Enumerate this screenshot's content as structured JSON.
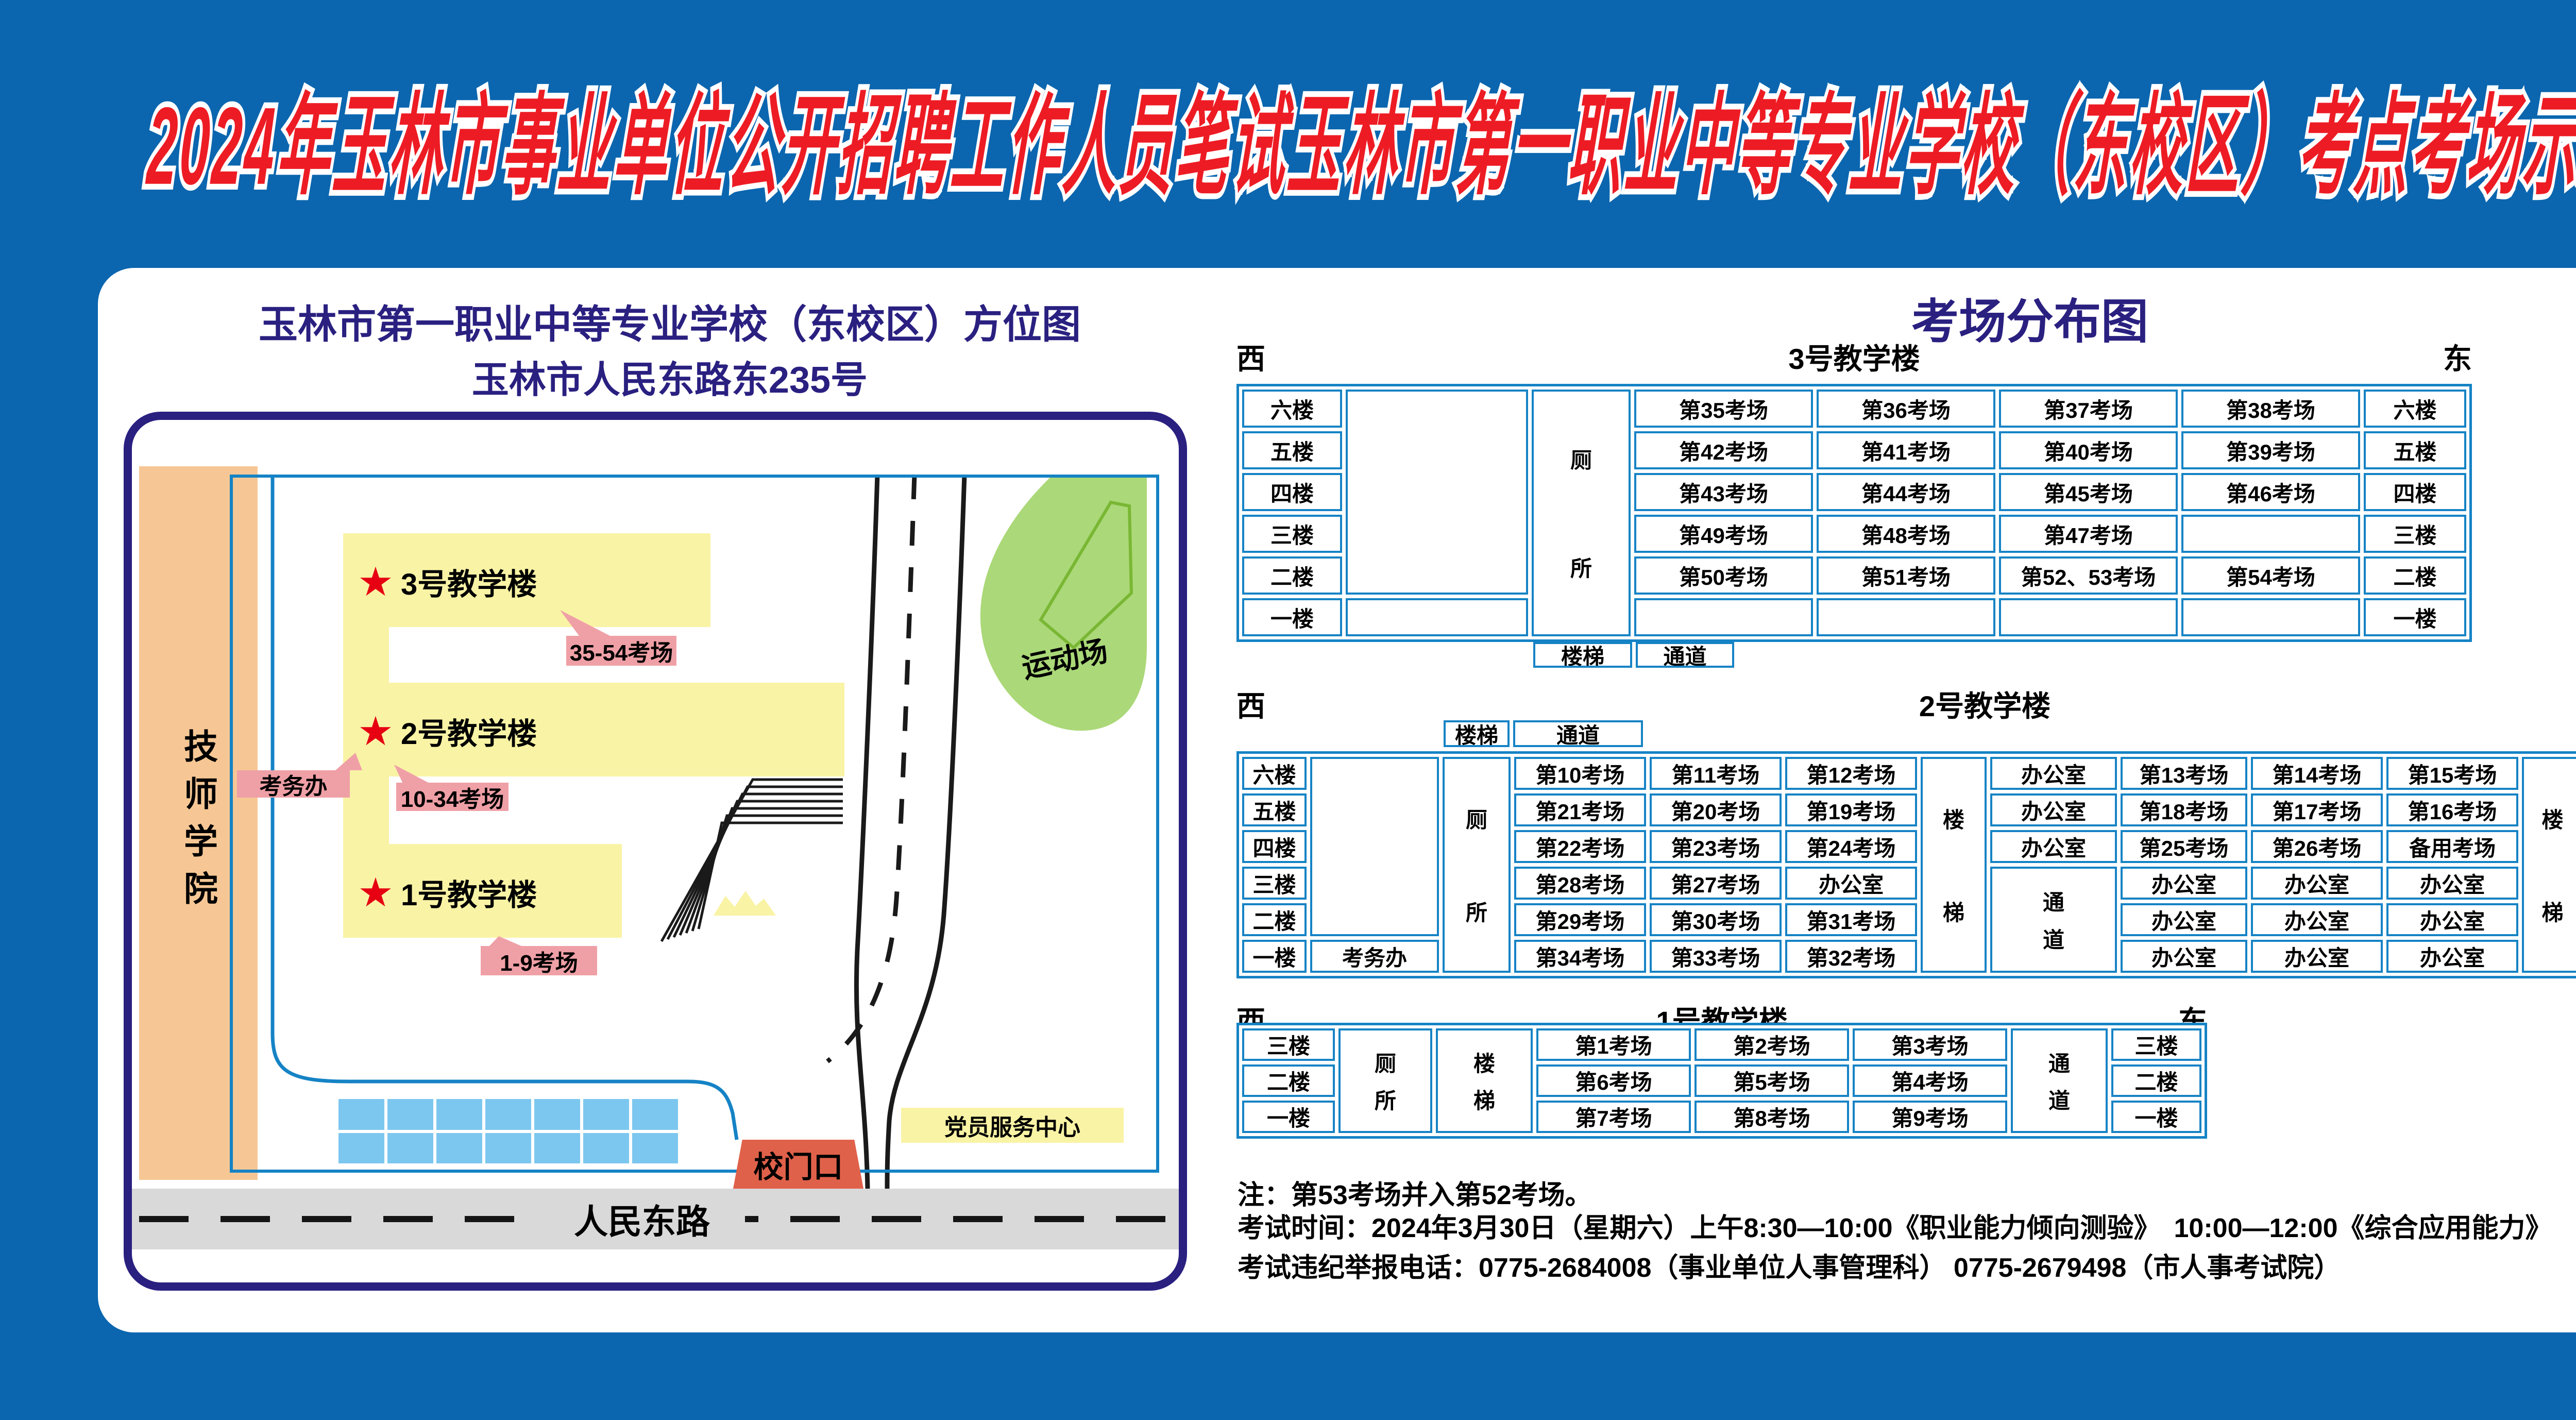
{
  "title": "2024年玉林市事业单位公开招聘工作人员笔试玉林市第一职业中等专业学校（东校区）考点考场示意图",
  "colors": {
    "background": "#0b66af",
    "title_fill": "#ed1c24",
    "title_outline": "#ffffff",
    "navy_heading": "#2a2080",
    "table_border": "#1583c5",
    "building_yellow": "#f9f3a5",
    "callout_pink": "#efa0a6",
    "college_orange": "#f6c795",
    "playground_green": "#abd878",
    "parking_blue": "#7cc7ef",
    "road_gray": "#d9d9da",
    "gate_red": "#e0614a",
    "star_red": "#e60012"
  },
  "map": {
    "title1": "玉林市第一职业中等专业学校（东校区）方位图",
    "title2": "玉林市人民东路东235号",
    "tech_college": "技师学院",
    "b3": {
      "star": "★",
      "name": "3号教学楼",
      "callout": "35-54考场"
    },
    "b2": {
      "star": "★",
      "name": "2号教学楼",
      "callout": "10-34考场"
    },
    "b1": {
      "star": "★",
      "name": "1号教学楼",
      "callout": "1-9考场"
    },
    "exam_office": "考务办",
    "playground": "运动场",
    "gate": "校门口",
    "party_center": "党员服务中心",
    "road": "人民东路"
  },
  "dist": {
    "title": "考场分布图",
    "west": "西",
    "east": "东",
    "stair": "楼梯",
    "passage": "通道",
    "toilet": "厕所",
    "b3": {
      "name": "3号教学楼",
      "rows": [
        {
          "floor": "六楼",
          "r": [
            "第35考场",
            "第36考场",
            "第37考场",
            "第38考场"
          ]
        },
        {
          "floor": "五楼",
          "r": [
            "第42考场",
            "第41考场",
            "第40考场",
            "第39考场"
          ]
        },
        {
          "floor": "四楼",
          "r": [
            "第43考场",
            "第44考场",
            "第45考场",
            "第46考场"
          ]
        },
        {
          "floor": "三楼",
          "r": [
            "第49考场",
            "第48考场",
            "第47考场",
            ""
          ]
        },
        {
          "floor": "二楼",
          "r": [
            "第50考场",
            "第51考场",
            "第52、53考场",
            "第54考场"
          ]
        },
        {
          "floor": "一楼",
          "r": [
            "",
            "",
            "",
            ""
          ]
        }
      ]
    },
    "b2": {
      "name": "2号教学楼",
      "rows": [
        {
          "floor": "六楼",
          "w": [
            "第10考场",
            "第11考场",
            "第12考场"
          ],
          "m": [
            "办公室",
            "第13考场",
            "第14考场",
            "第15考场"
          ],
          "t": "厕所"
        },
        {
          "floor": "五楼",
          "w": [
            "第21考场",
            "第20考场",
            "第19考场"
          ],
          "m": [
            "办公室",
            "第18考场",
            "第17考场",
            "第16考场"
          ],
          "t": "厕所"
        },
        {
          "floor": "四楼",
          "w": [
            "第22考场",
            "第23考场",
            "第24考场"
          ],
          "m": [
            "办公室",
            "第25考场",
            "第26考场",
            "备用考场"
          ],
          "t": "厕所"
        },
        {
          "floor": "三楼",
          "w": [
            "第28考场",
            "第27考场",
            "办公室"
          ],
          "m": [
            "办公室",
            "办公室",
            "办公室"
          ],
          "t": "厕所"
        },
        {
          "floor": "二楼",
          "w": [
            "第29考场",
            "第30考场",
            "第31考场"
          ],
          "m": [
            "办公室",
            "办公室",
            "办公室"
          ],
          "t": "厕所"
        },
        {
          "floor": "一楼",
          "office": "考务办",
          "w": [
            "第34考场",
            "第33考场",
            "第32考场"
          ],
          "m": [
            "办公室",
            "办公室",
            "办公室"
          ],
          "t": "厕所"
        }
      ]
    },
    "b1": {
      "name": "1号教学楼",
      "rows": [
        {
          "floor": "三楼",
          "r": [
            "第1考场",
            "第2考场",
            "第3考场"
          ]
        },
        {
          "floor": "二楼",
          "r": [
            "第6考场",
            "第5考场",
            "第4考场"
          ]
        },
        {
          "floor": "一楼",
          "r": [
            "第7考场",
            "第8考场",
            "第9考场"
          ]
        }
      ]
    },
    "notes": {
      "n1": "注：第53考场并入第52考场。",
      "n2": "考试时间：2024年3月30日（星期六）上午8:30—10:00《职业能力倾向测验》　10:00—12:00《综合应用能力》",
      "n3": "考试违纪举报电话：0775-2684008（事业单位人事管理科） 0775-2679498（市人事考试院）"
    }
  }
}
